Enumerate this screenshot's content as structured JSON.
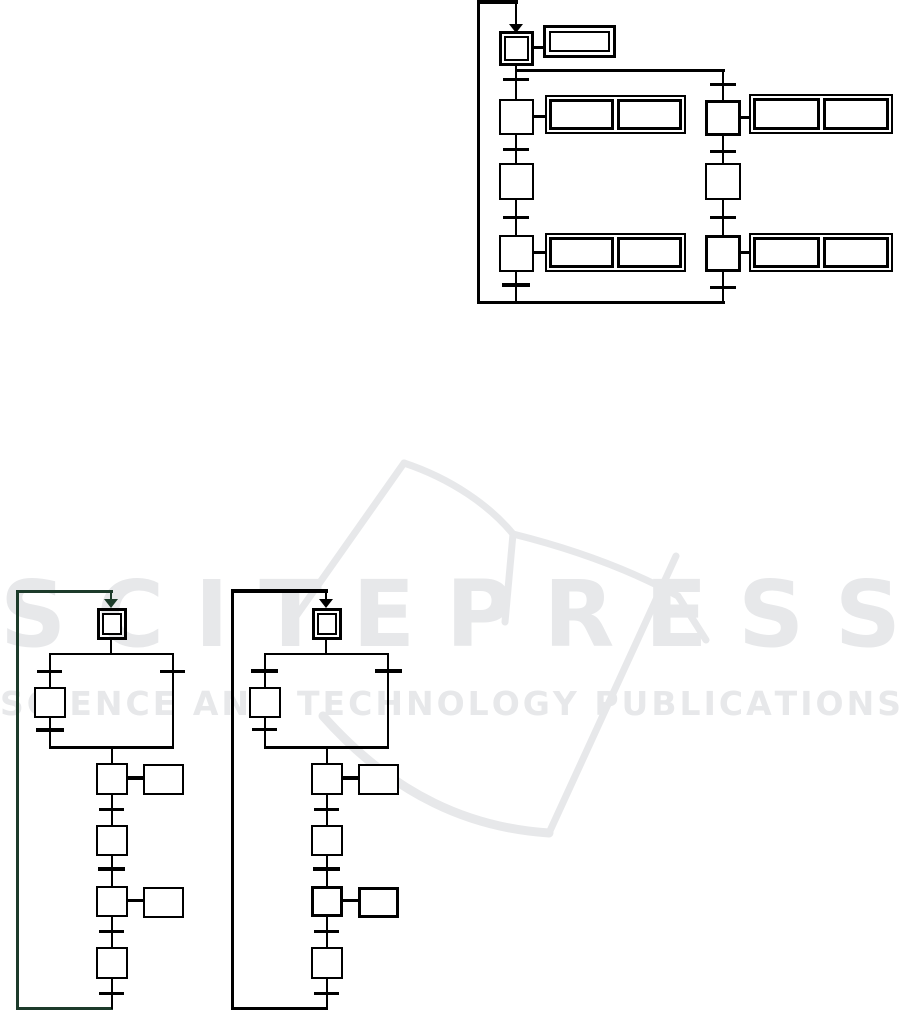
{
  "watermark": {
    "brand": "SCITEPRESS",
    "tagline": "SCIENCE AND TECHNOLOGY PUBLICATIONS",
    "color": "#e7e8ea"
  },
  "colors": {
    "ink": "#000000",
    "loop_left_diagram": "#1c3b2a",
    "background": "#ffffff"
  },
  "figure": {
    "type": "sfc-grafcet-diagrams",
    "diagrams": [
      {
        "id": "top-right",
        "initial_steps": 1,
        "steps": 6,
        "action_blocks": 5,
        "branches": 2,
        "loop": true
      },
      {
        "id": "bottom-left",
        "initial_steps": 1,
        "steps": 5,
        "action_boxes": 2,
        "branches": 2,
        "loop": true
      },
      {
        "id": "bottom-center",
        "initial_steps": 1,
        "steps": 5,
        "action_boxes": 2,
        "branches": 2,
        "loop": true
      }
    ],
    "labels_visible": false
  }
}
